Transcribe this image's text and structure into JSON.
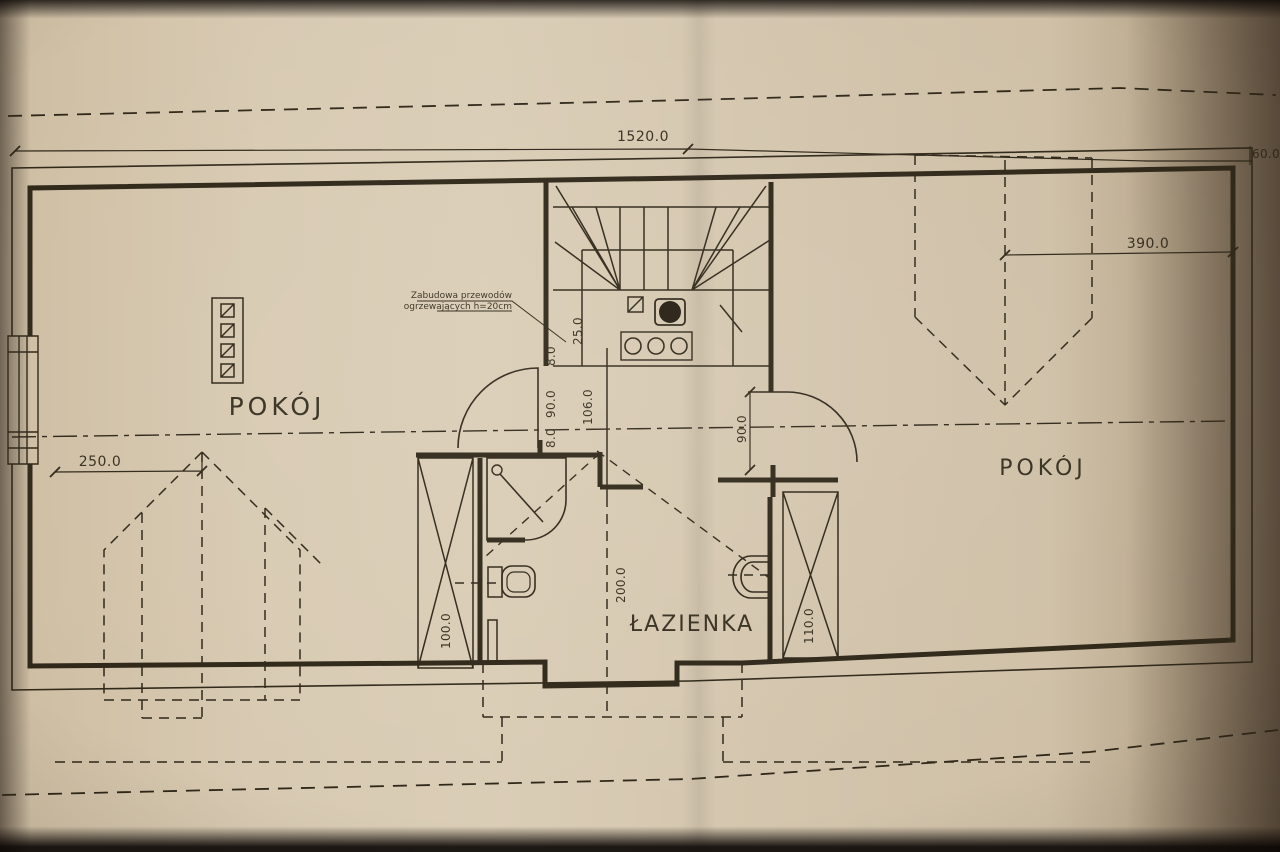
{
  "drawing": {
    "kind": "floor-plan-photo",
    "language": "pl"
  },
  "colors": {
    "paper": "#d6c8b0",
    "ink": "#2f2718"
  },
  "labels": {
    "room_left": "POKÓJ",
    "room_right": "POKÓJ",
    "bathroom": "ŁAZIENKA"
  },
  "annotation": {
    "line1": "Zabudowa przewodów",
    "line2": "ogrzewających h=20cm"
  },
  "dimensions": {
    "overall_width": "1520.0",
    "right_edge": "60.0",
    "dormer_right": "390.0",
    "dormer_left": "250.0",
    "stair_recess": "25.0",
    "jamb_upper": "8.0",
    "door_left_width": "90.0",
    "jamb_lower": "8.0",
    "passage_width": "106.0",
    "left_duct": "100.0",
    "bathroom_length": "200.0",
    "right_duct": "110.0",
    "door_right_width": "90.0"
  }
}
